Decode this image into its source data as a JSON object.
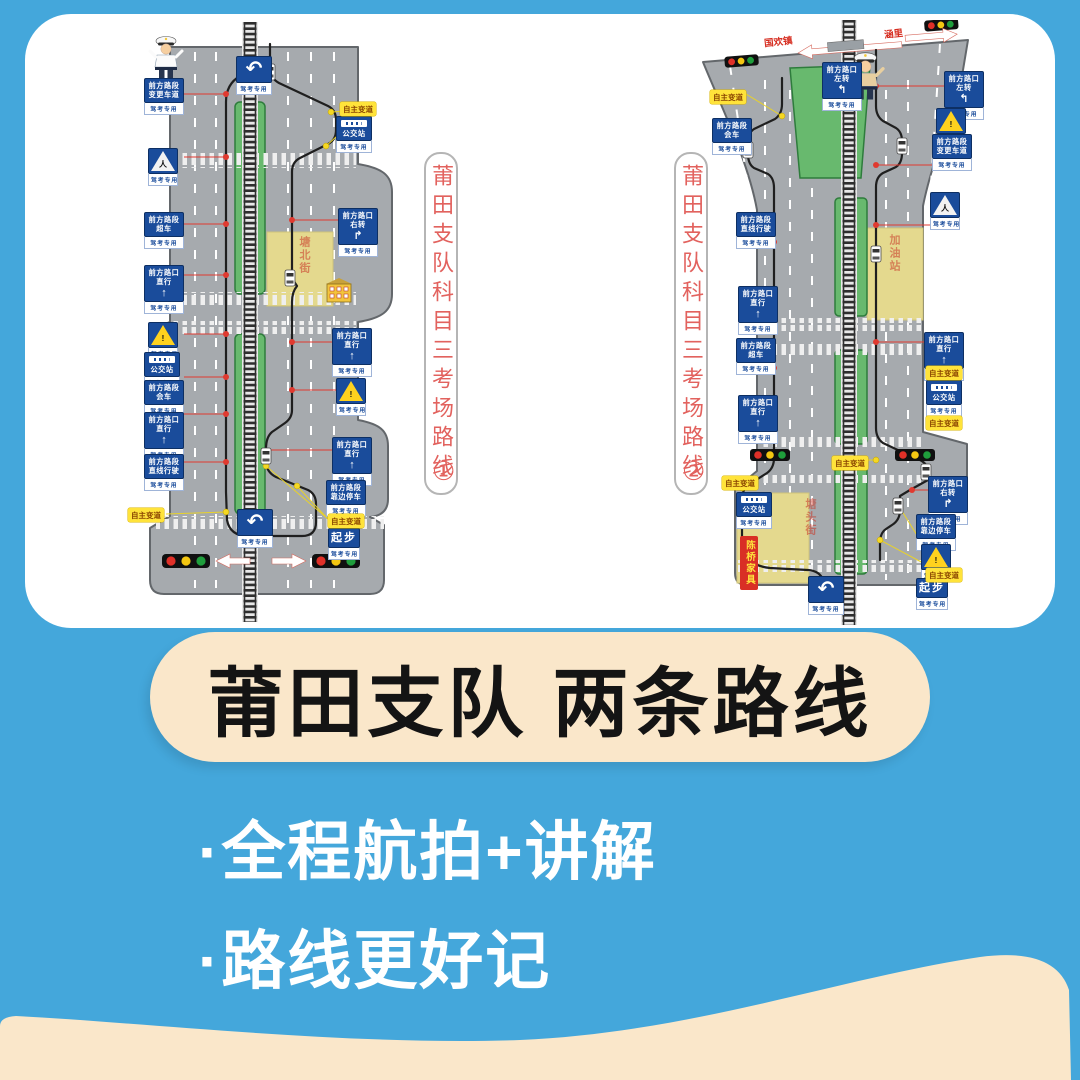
{
  "title": "莆田支队 两条路线",
  "bullets": [
    "·全程航拍+讲解",
    "·路线更好记"
  ],
  "panel1": {
    "text": "莆田支队科目三考场路线",
    "number": "①"
  },
  "panel2": {
    "text": "莆田支队科目三考场路线",
    "number": "②"
  },
  "colors": {
    "background": "#44A7DB",
    "cream": "#FAE7CA",
    "sign_blue": "#1A4C9B",
    "road_gray": "#A6AAAE",
    "median_green": "#68B96E",
    "route_red": "#E03A30",
    "label_yellow": "#FFE33A",
    "caption_red": "#E2625E"
  },
  "common": {
    "exam_label": "驾考专用"
  },
  "maps": [
    {
      "name": "route-map-1",
      "signs": [
        {
          "t": "u",
          "x": 136,
          "y": 34,
          "sub": true
        },
        {
          "t": "b",
          "x": 44,
          "y": 56,
          "l": [
            "前方路段",
            "变更车道"
          ],
          "sub": true
        },
        {
          "t": "warn",
          "w": "ped",
          "x": 48,
          "y": 126,
          "sub": true
        },
        {
          "t": "b",
          "x": 44,
          "y": 190,
          "l": [
            "前方路段",
            "超车"
          ],
          "sub": true
        },
        {
          "t": "b",
          "x": 44,
          "y": 243,
          "l": [
            "前方路口",
            "直行"
          ],
          "a": "↑",
          "sub": true
        },
        {
          "t": "warn",
          "w": "bang",
          "x": 48,
          "y": 300,
          "sub": true
        },
        {
          "t": "bus",
          "x": 44,
          "y": 330,
          "l": [
            "公交站"
          ],
          "sub": true
        },
        {
          "t": "b",
          "x": 44,
          "y": 358,
          "l": [
            "前方路段",
            "会车"
          ],
          "sub": true
        },
        {
          "t": "b",
          "x": 44,
          "y": 390,
          "l": [
            "前方路口",
            "直行"
          ],
          "a": "↑",
          "sub": true
        },
        {
          "t": "b",
          "x": 44,
          "y": 432,
          "l": [
            "前方路段",
            "直线行驶"
          ],
          "sub": true
        },
        {
          "t": "y",
          "x": 28,
          "y": 486,
          "l": [
            "自主变道"
          ]
        },
        {
          "t": "y",
          "x": 240,
          "y": 80,
          "l": [
            "自主变道"
          ]
        },
        {
          "t": "bus",
          "x": 236,
          "y": 94,
          "l": [
            "公交站"
          ],
          "sub": true
        },
        {
          "t": "b",
          "x": 238,
          "y": 186,
          "l": [
            "前方路口",
            "右转"
          ],
          "a": "↱",
          "sub": true
        },
        {
          "t": "b",
          "x": 232,
          "y": 306,
          "l": [
            "前方路口",
            "直行"
          ],
          "a": "↑",
          "sub": true
        },
        {
          "t": "warn",
          "w": "bang",
          "x": 236,
          "y": 356,
          "sub": true
        },
        {
          "t": "b",
          "x": 232,
          "y": 415,
          "l": [
            "前方路口",
            "直行"
          ],
          "a": "↑",
          "sub": true
        },
        {
          "t": "b",
          "x": 226,
          "y": 458,
          "l": [
            "前方路段",
            "靠边停车"
          ],
          "sub": true
        },
        {
          "t": "y",
          "x": 228,
          "y": 492,
          "l": [
            "自主变道"
          ]
        },
        {
          "t": "go",
          "x": 228,
          "y": 506,
          "l": [
            "起步"
          ],
          "sub": true
        },
        {
          "t": "u",
          "x": 137,
          "y": 487,
          "sub": true
        },
        {
          "t": "rt",
          "x": 196,
          "y": 214,
          "l": [
            "塘北街"
          ]
        }
      ]
    },
    {
      "name": "route-map-2",
      "signs": [
        {
          "t": "al",
          "x": 74,
          "y": 14,
          "l": [
            "国欢镇"
          ],
          "r": -6
        },
        {
          "t": "al",
          "x": 194,
          "y": 6,
          "l": [
            "涵里"
          ],
          "r": -6
        },
        {
          "t": "b",
          "x": 132,
          "y": 42,
          "l": [
            "前方路口",
            "左转"
          ],
          "a": "↰",
          "sub": true
        },
        {
          "t": "y",
          "x": 20,
          "y": 70,
          "l": [
            "自主变道"
          ]
        },
        {
          "t": "b",
          "x": 22,
          "y": 98,
          "l": [
            "前方路段",
            "会车"
          ],
          "sub": true
        },
        {
          "t": "b",
          "x": 46,
          "y": 192,
          "l": [
            "前方路段",
            "直线行驶"
          ],
          "sub": true
        },
        {
          "t": "b",
          "x": 48,
          "y": 266,
          "l": [
            "前方路口",
            "直行"
          ],
          "a": "↑",
          "sub": true
        },
        {
          "t": "b",
          "x": 46,
          "y": 318,
          "l": [
            "前方路段",
            "超车"
          ],
          "sub": true
        },
        {
          "t": "b",
          "x": 48,
          "y": 375,
          "l": [
            "前方路口",
            "直行"
          ],
          "a": "↑",
          "sub": true
        },
        {
          "t": "y",
          "x": 32,
          "y": 456,
          "l": [
            "自主变道"
          ]
        },
        {
          "t": "bus",
          "x": 46,
          "y": 472,
          "l": [
            "公交站"
          ],
          "sub": true
        },
        {
          "t": "red",
          "x": 50,
          "y": 516,
          "l": [
            "陈桥家具"
          ]
        },
        {
          "t": "b",
          "x": 254,
          "y": 51,
          "l": [
            "前方路口",
            "左转"
          ],
          "a": "↰",
          "sub": true
        },
        {
          "t": "warn",
          "w": "bang",
          "x": 246,
          "y": 88,
          "sub": true
        },
        {
          "t": "b",
          "x": 242,
          "y": 114,
          "l": [
            "前方路段",
            "变更车道"
          ],
          "sub": true
        },
        {
          "t": "warn",
          "w": "ped",
          "x": 240,
          "y": 172,
          "sub": true
        },
        {
          "t": "b",
          "x": 234,
          "y": 312,
          "l": [
            "前方路口",
            "直行"
          ],
          "a": "↑",
          "sub": true
        },
        {
          "t": "y",
          "x": 236,
          "y": 346,
          "l": [
            "自主变道"
          ]
        },
        {
          "t": "bus",
          "x": 236,
          "y": 360,
          "l": [
            "公交站"
          ],
          "sub": true
        },
        {
          "t": "y",
          "x": 236,
          "y": 396,
          "l": [
            "自主变道"
          ]
        },
        {
          "t": "b",
          "x": 238,
          "y": 456,
          "l": [
            "前方路口",
            "右转"
          ],
          "a": "↱",
          "sub": true
        },
        {
          "t": "b",
          "x": 226,
          "y": 494,
          "l": [
            "前方路段",
            "靠边停车"
          ],
          "sub": true
        },
        {
          "t": "warn",
          "w": "bang",
          "x": 231,
          "y": 524,
          "sub": true
        },
        {
          "t": "y",
          "x": 236,
          "y": 548,
          "l": [
            "自主变道"
          ]
        },
        {
          "t": "go",
          "x": 226,
          "y": 558,
          "l": [
            "起步"
          ],
          "sub": true
        },
        {
          "t": "y",
          "x": 142,
          "y": 436,
          "l": [
            "自主变道"
          ]
        },
        {
          "t": "u",
          "x": 118,
          "y": 556,
          "sub": true
        },
        {
          "t": "rt",
          "x": 196,
          "y": 214,
          "l": [
            "加油站"
          ]
        },
        {
          "t": "rt",
          "x": 112,
          "y": 478,
          "l": [
            "塘头街"
          ]
        }
      ]
    }
  ]
}
